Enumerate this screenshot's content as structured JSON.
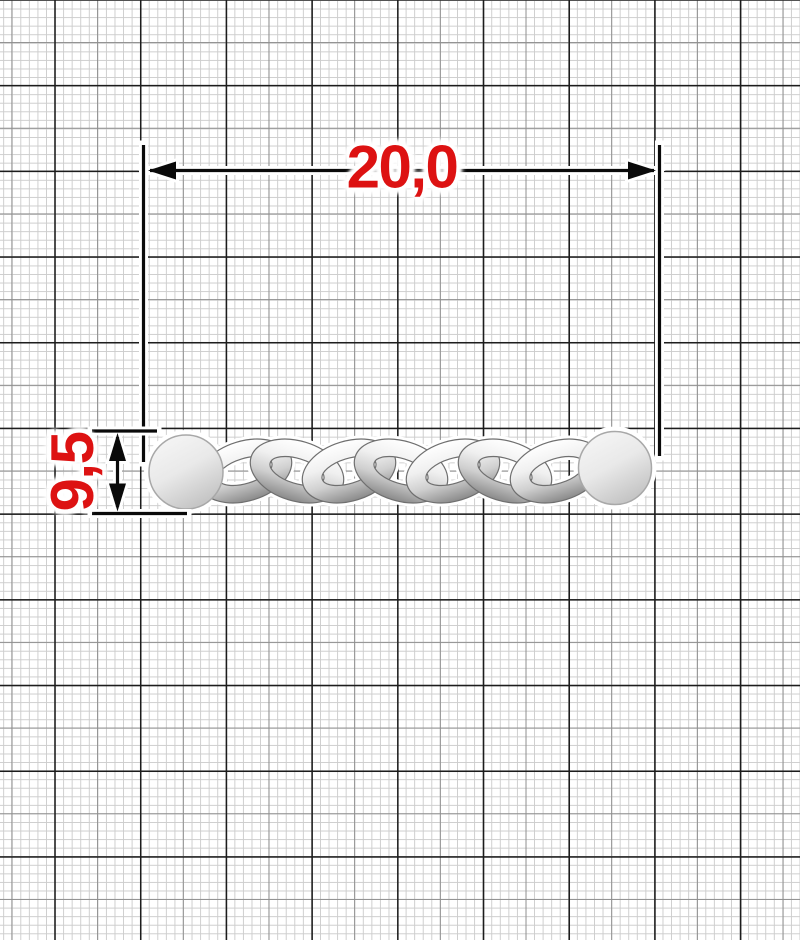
{
  "drawing": {
    "title": "curb chain segment technical drawing on millimeter graph paper",
    "object": "curb chain with two round end plates",
    "dimension_width": {
      "label": "20,0"
    },
    "dimension_height": {
      "label": "9,5"
    },
    "chain": {
      "type": "curb",
      "links_visible": 7,
      "end_plates": 2
    },
    "colors": {
      "dimension_text": "#dd1212",
      "dimension_lines": "#0a0a0a",
      "grid_major": "#1c1c1c",
      "grid_medium": "#8f8f8f",
      "grid_minor": "#cdcdcd",
      "metal_highlight": "#ffffff",
      "metal_shadow": "#8a8a8a",
      "paper": "#ffffff"
    }
  }
}
